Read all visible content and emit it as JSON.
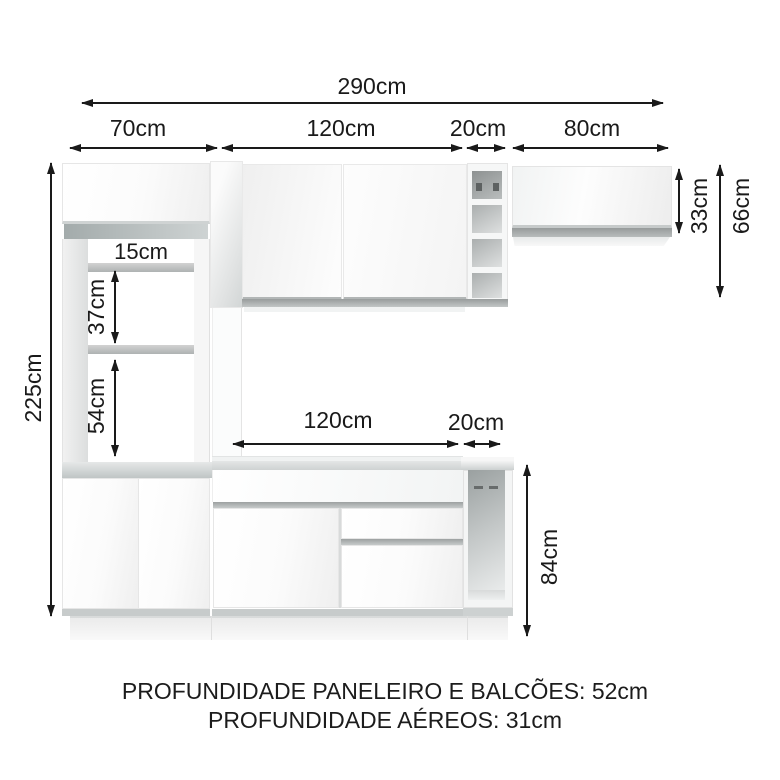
{
  "dimensions": {
    "total_width": "290cm",
    "top": {
      "pantry": "70cm",
      "center": "120cm",
      "niche": "20cm",
      "right": "80cm"
    },
    "left_height": "225cm",
    "right": {
      "upper_cabinet": "33cm",
      "upper_total": "66cm"
    },
    "pantry_gaps": {
      "gap1": "15cm",
      "gap2": "37cm",
      "gap3": "54cm"
    },
    "counter": {
      "center": "120cm",
      "niche": "20cm"
    },
    "base_height": "84cm"
  },
  "footer": {
    "line1": "PROFUNDIDADE PANELEIRO E BALCÕES: 52cm",
    "line2": "PROFUNDIDADE AÉREOS: 31cm"
  },
  "colors": {
    "ink": "#1a1a1a",
    "cabinet_white": "#fbfbfb",
    "handle_gray": "#a0a4a4",
    "shelf_gray": "#b3b7b7",
    "counter_gray": "#c6caca"
  }
}
